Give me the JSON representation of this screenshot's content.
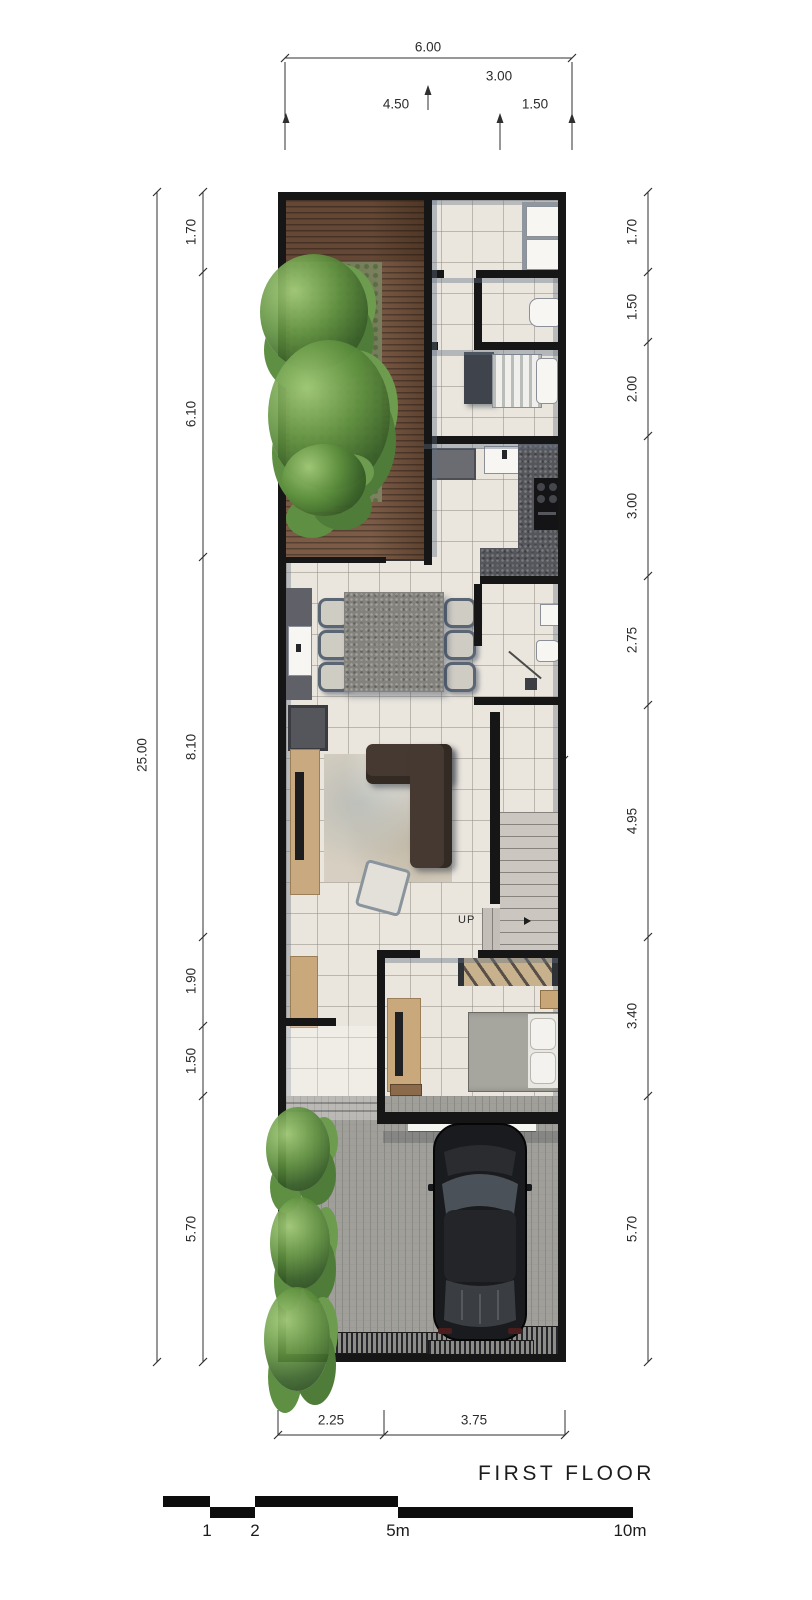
{
  "title": "FIRST FLOOR",
  "stairs_label": "UP",
  "dims": {
    "top": {
      "total": "6.00",
      "right": "3.00",
      "left_sub": "4.50",
      "right_sub": "1.50"
    },
    "left": {
      "total": "25.00",
      "segs": [
        "1.70",
        "6.10",
        "8.10",
        "1.90",
        "1.50",
        "5.70"
      ]
    },
    "right": {
      "segs": [
        "1.70",
        "1.50",
        "2.00",
        "3.00",
        "2.75",
        "4.95",
        "3.40",
        "5.70"
      ]
    },
    "bottom": {
      "segs": [
        "2.25",
        "3.75"
      ]
    },
    "interior": {
      "stair_corridor_width": "1.50"
    }
  },
  "scalebar": {
    "labels": [
      "1",
      "2",
      "5m",
      "10m"
    ]
  },
  "colors": {
    "wall": "#161616",
    "tile_floor": "#eae6de",
    "deck_wood": "#7b5b46",
    "garden": "#7e8161",
    "foliage": "#4f7c38",
    "counter_granite": "#55565b",
    "table_granite": "#83827c",
    "marble_stairs": "#cbc7c0",
    "pavers": "#a09f9a",
    "sofa": "#453931",
    "bed_duvet": "#a6a59e",
    "wood_furniture": "#c9a87c",
    "dimension_text": "#2b2b2b"
  }
}
